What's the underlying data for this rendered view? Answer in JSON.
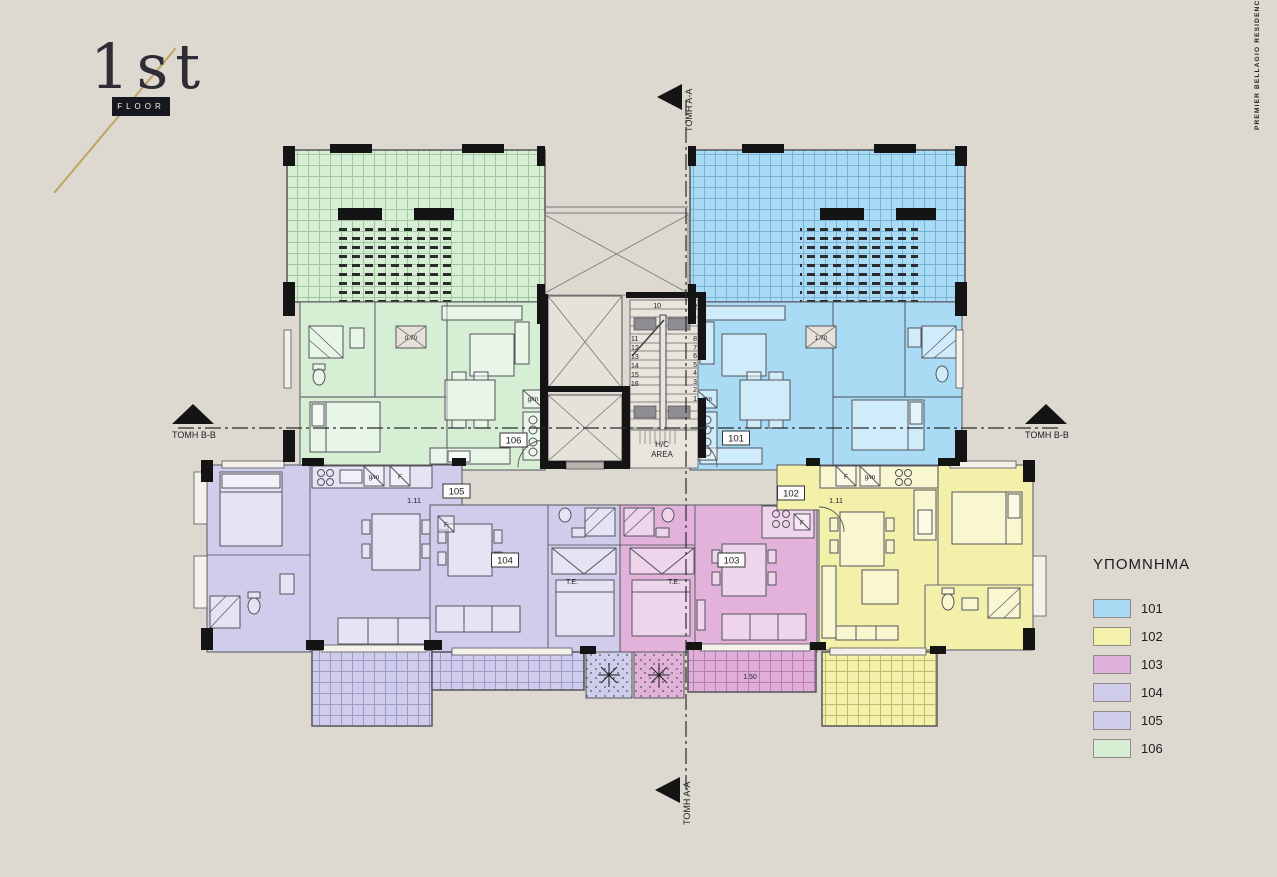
{
  "logo": {
    "floor_number": "1st",
    "floor_word": "FLOOR"
  },
  "brand": {
    "vertical_text": "PREMIER BELLAGIO RESIDENCES"
  },
  "legend": {
    "title": "ΥΠΟΜΝΗΜΑ",
    "items": [
      {
        "id": "101",
        "color": "#a9dbf5"
      },
      {
        "id": "102",
        "color": "#f5f2ad"
      },
      {
        "id": "103",
        "color": "#dfb0d9"
      },
      {
        "id": "104",
        "color": "#cfcdeb"
      },
      {
        "id": "105",
        "color": "#cfcdeb"
      },
      {
        "id": "106",
        "color": "#d6eed4"
      }
    ]
  },
  "sections": {
    "aa": "ΤΟΜΗ Α-Α",
    "bb": "ΤΟΜΗ Β-Β"
  },
  "units": {
    "u101": "101",
    "u102": "102",
    "u103": "103",
    "u104": "104",
    "u105": "105",
    "u106": "106"
  },
  "stairs": {
    "numbers": [
      "1",
      "2",
      "3",
      "4",
      "5",
      "6",
      "7",
      "8",
      "9",
      "10",
      "11",
      "12",
      "13",
      "14",
      "15",
      "16"
    ]
  },
  "labels": {
    "hc_line1": "H/C",
    "hc_line2": "AREA",
    "te": "T.E.",
    "gm": "g/m",
    "f": "F",
    "dim_111": "1.11",
    "dim_170": "1.70",
    "dim_070": "0.70",
    "dim_150": "1.50"
  },
  "colors": {
    "background": "#ddd9d1",
    "accent_gold": "#c0a35e",
    "ink": "#1c1c1e",
    "wall_black": "#141414",
    "unit_101": "#a9dbf5",
    "unit_102": "#f5f2ad",
    "unit_103": "#dfb0d9",
    "unit_104": "#cfcdeb",
    "unit_105": "#cfcdeb",
    "unit_106": "#d6eed4"
  }
}
